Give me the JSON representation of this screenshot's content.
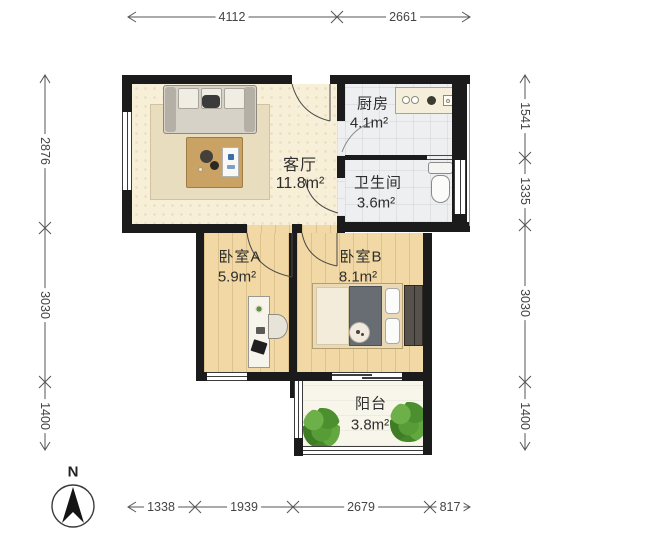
{
  "floorplan": {
    "compass_label": "N",
    "rooms": {
      "living": {
        "name": "客厅",
        "area": "11.8m²"
      },
      "kitchen": {
        "name": "厨房",
        "area": "4.1m²"
      },
      "bath": {
        "name": "卫生间",
        "area": "3.6m²"
      },
      "bedroomA": {
        "name": "卧室A",
        "area": "5.9m²"
      },
      "bedroomB": {
        "name": "卧室B",
        "area": "8.1m²"
      },
      "balcony": {
        "name": "阳台",
        "area": "3.8m²"
      }
    },
    "dimensions_mm": {
      "top": [
        "4112",
        "2661"
      ],
      "bottom": [
        "1338",
        "1939",
        "2679",
        "817"
      ],
      "left": [
        "2876",
        "3030",
        "1400"
      ],
      "right": [
        "1541",
        "1335",
        "3030",
        "1400"
      ]
    },
    "colors": {
      "wall": "#1b1b1b",
      "living_floor": "#f7efd7",
      "wood_floor": "#f1d8a4",
      "tile_floor": "#edeff0",
      "balcony_floor": "#f8f6ea",
      "plant_green": "#579c36",
      "dimension_line": "#555555",
      "label_text": "#2e2e2e"
    }
  }
}
